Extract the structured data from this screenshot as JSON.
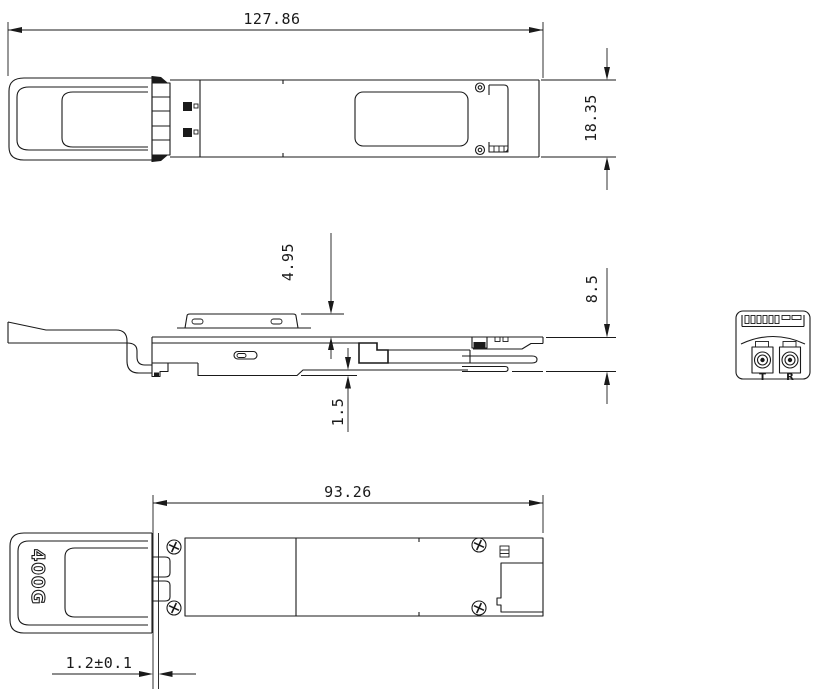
{
  "drawing": {
    "dimensions": {
      "overall_length": "127.86",
      "overall_width": "18.35",
      "pad_height": "4.95",
      "body_height": "8.5",
      "bottom_rail_height": "1.5",
      "insertion_length": "93.26",
      "flange_offset": "1.2±0.1"
    },
    "labels": {
      "pull_tab_text": "400G",
      "port_left": "T",
      "port_right": "R"
    },
    "colors": {
      "line": "#1a1a1a",
      "background": "#ffffff"
    }
  }
}
